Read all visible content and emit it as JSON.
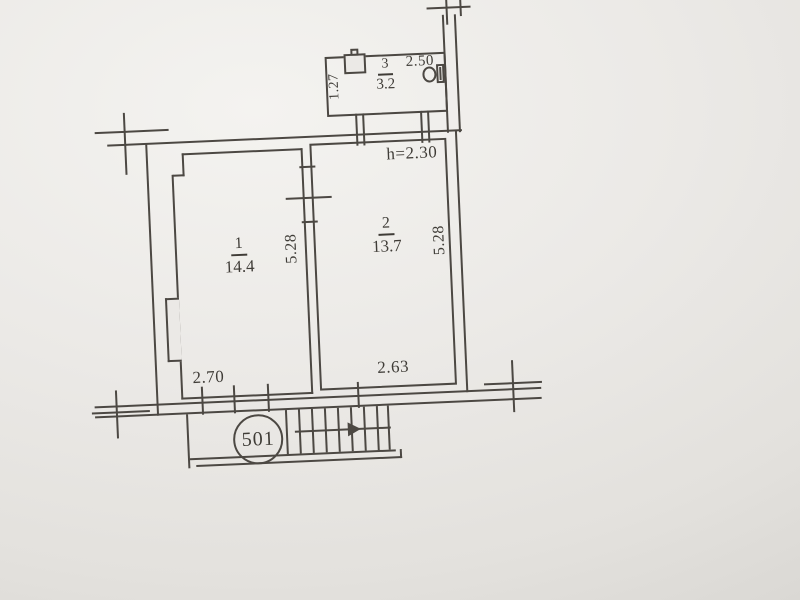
{
  "plan": {
    "apartment_number": "501",
    "rooms": [
      {
        "number": "1",
        "area": "14.4"
      },
      {
        "number": "2",
        "area": "13.7"
      },
      {
        "number": "3",
        "area": "3.2"
      }
    ],
    "dimensions": {
      "room1_width": "2.70",
      "room2_width": "2.63",
      "room1_depth": "5.28",
      "room2_depth": "5.28",
      "bathroom_depth": "1.27",
      "bathroom_width": "2.50",
      "ceiling_height": "h=2.30"
    },
    "colors": {
      "paper": "#ebe9e6",
      "line": "#4c4843",
      "text": "#3f3c37"
    }
  }
}
